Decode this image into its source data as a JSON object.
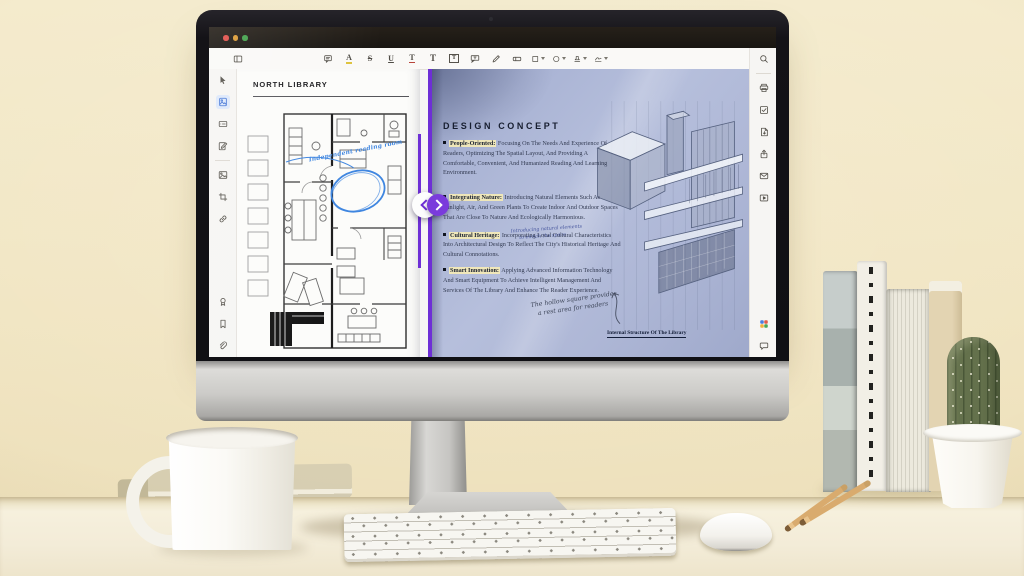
{
  "window": {
    "controls": [
      {
        "name": "close",
        "color": "#e0504a"
      },
      {
        "name": "minimize",
        "color": "#dc9b35"
      },
      {
        "name": "zoom",
        "color": "#43a24c"
      }
    ]
  },
  "toolbar": {
    "left_icons": [
      {
        "name": "panel-toggle"
      }
    ],
    "center_icons": [
      {
        "name": "note-comment"
      },
      {
        "name": "highlight-text"
      },
      {
        "name": "strikethrough"
      },
      {
        "name": "underline"
      },
      {
        "name": "squiggly-underline"
      },
      {
        "name": "add-text"
      },
      {
        "name": "text-box"
      },
      {
        "name": "text-callout"
      },
      {
        "name": "pencil"
      },
      {
        "name": "eraser"
      },
      {
        "name": "shapes",
        "dropdown": true
      },
      {
        "name": "freehand-shape",
        "dropdown": true
      },
      {
        "name": "stamp",
        "dropdown": true
      },
      {
        "name": "signature",
        "dropdown": true
      }
    ],
    "right_icons": [
      {
        "name": "search"
      }
    ]
  },
  "left_sidebar": {
    "top_icons": [
      {
        "name": "select-cursor"
      },
      {
        "name": "page-thumbnails",
        "active": true
      },
      {
        "name": "form-field"
      },
      {
        "name": "edit-content"
      },
      {
        "name": "sep"
      },
      {
        "name": "insert-image"
      },
      {
        "name": "crop-page"
      },
      {
        "name": "link"
      }
    ],
    "bottom_icons": [
      {
        "name": "stamp-seal"
      },
      {
        "name": "bookmark"
      },
      {
        "name": "attachment"
      }
    ]
  },
  "right_sidebar": {
    "top_icons": [
      {
        "name": "print"
      },
      {
        "name": "approve-check"
      },
      {
        "name": "export-file"
      },
      {
        "name": "share"
      },
      {
        "name": "email"
      },
      {
        "name": "slideshow"
      }
    ],
    "bottom_icons": [
      {
        "name": "ai-assistant"
      },
      {
        "name": "feedback-chat"
      }
    ]
  },
  "compare_slider": {
    "left_arrow": "previous",
    "right_arrow": "next"
  },
  "document": {
    "left_page": {
      "title": "NORTH LIBRARY",
      "handwritten_annotation": "Independent reading room"
    },
    "right_page": {
      "heading": "DESIGN CONCEPT",
      "bullets": [
        {
          "lead": "People-Oriented:",
          "text": "Focusing On The Needs And Experience Of Readers, Optimizing The Spatial Layout, And Providing A Comfortable, Convenient, And Humanized Reading And Learning Environment."
        },
        {
          "lead": "Integrating Nature:",
          "text": "Introducing Natural Elements Such As Sunlight, Air, And Green Plants To Create Indoor And Outdoor Spaces That Are Close To Nature And Ecologically Harmonious.",
          "note_line1": "Introducing natural elements",
          "note_line2": "to enrich the space"
        },
        {
          "lead": "Cultural Heritage:",
          "text": "Incorporating Local Cultural Characteristics Into Architectural Design To Reflect The City's Historical Heritage And Cultural Connotations."
        },
        {
          "lead": "Smart Innovation:",
          "text": "Applying Advanced Information Technology And Smart Equipment To Achieve Intelligent Management And Services Of The Library And Enhance The Reader Experience."
        }
      ],
      "handwritten_note_line1": "The hollow square provides",
      "handwritten_note_line2": "a rest area for readers",
      "caption": "Internal Structure Of The Library"
    }
  },
  "colors": {
    "accent_purple": "#6e2fd6",
    "annotation_blue": "#3f86e0",
    "lead_highlight": "#faeeb4",
    "right_page_tint": "#aeb8d8"
  }
}
